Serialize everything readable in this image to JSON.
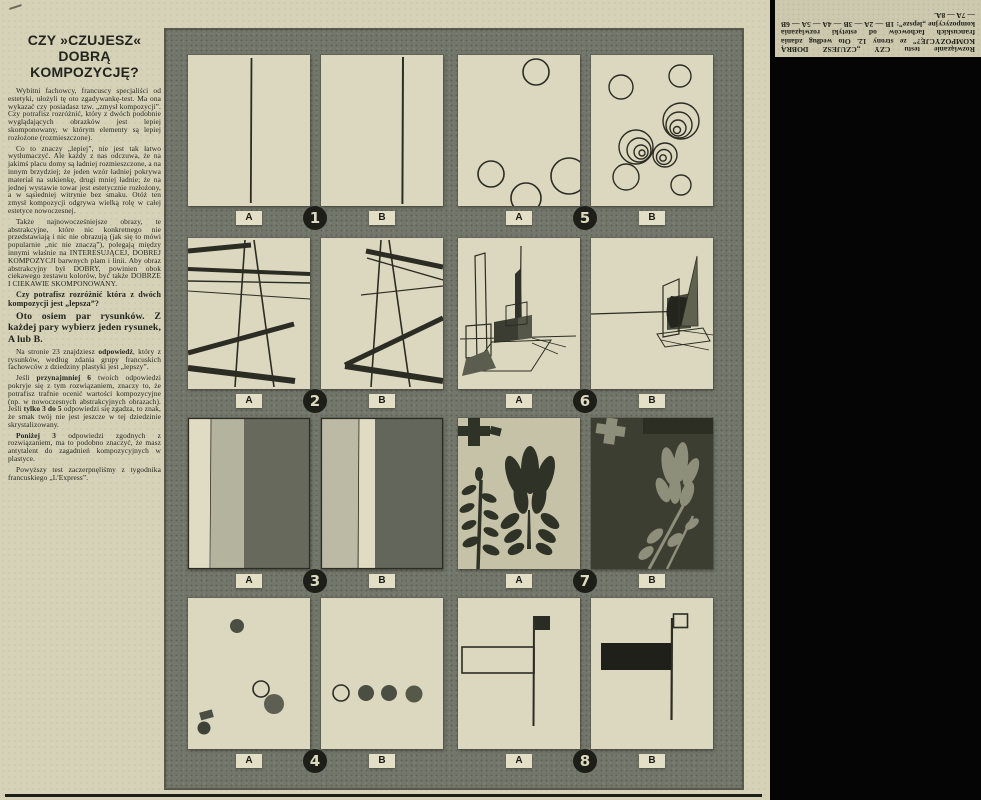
{
  "article": {
    "title": "CZY »CZUJESZ«\nDOBRĄ\nKOMPOZYCJĘ?",
    "paragraphs": [
      {
        "cls": "p-normal",
        "seg": [
          {
            "t": "Wybitni fachowcy, francuscy specjaliści od estetyki, ułożyli tę oto zgadywankę-test. Ma ona wykazać czy posiadasz tzw. „zmysł kompozycji”. Czy potrafisz rozróżnić, który z dwóch podobnie wyglądających obrazków jest lepiej skomponowany, w którym elementy są lepiej rozłożone (rozmieszczone)."
          }
        ]
      },
      {
        "cls": "p-normal",
        "seg": [
          {
            "t": "Co to znaczy „lepiej”, nie jest tak łatwo wytłumaczyć. Ale każdy z nas odczuwa, że na jakimś placu domy są ładniej rozmieszczone, a na innym brzydziej; że jeden wzór ładniej pokrywa materiał na sukienkę, drugi mniej ładnie; że na jednej wystawie towar jest estetycznie rozłożony, a w sąsiedniej witrynie bez smaku. Otóż ten zmysł kompozycji odgrywa wielką rolę w całej estetyce nowoczesnej."
          }
        ]
      },
      {
        "cls": "p-normal",
        "seg": [
          {
            "t": "Także najnowocześniejsze obrazy, te abstrakcyjne, które nic konkretnego nie przedstawiają i nic nie obrazują (jak się to mówi popularnie „nic nie znaczą”), polegają między innymi właśnie na INTERESUJĄCEJ, DOBREJ KOMPOZYCJI barwnych plam i linii. Aby obraz abstrakcyjny był DOBRY, powinien obok ciekawego zestawu kolorów, być także DOBRZE I CIEKAWIE SKOMPONOWANY."
          }
        ]
      },
      {
        "cls": "p-bold-sm",
        "seg": [
          {
            "t": "Czy potrafisz rozróżnić która z dwóch kompozycji jest „lepsza”?"
          }
        ]
      },
      {
        "cls": "p-bold-lg",
        "seg": [
          {
            "t": "Oto osiem par rysunków. Z każdej pary wybierz jeden rysunek, A lub B."
          }
        ]
      },
      {
        "cls": "p-normal",
        "seg": [
          {
            "t": "Na stronie 23 znajdziesz "
          },
          {
            "t": "odpowiedź",
            "b": true
          },
          {
            "t": ", który z rysunków, według zdania grupy francuskich fachowców z dziedziny plastyki jest „lepszy”."
          }
        ]
      },
      {
        "cls": "p-normal",
        "seg": [
          {
            "t": "Jeśli "
          },
          {
            "t": "przynajmniej 6",
            "b": true
          },
          {
            "t": " twoich odpowiedzi pokryje się z tym rozwiązaniem, znaczy to, że potrafisz trafnie ocenić wartości kompozycyjne (np. w nowoczesnych abstrakcyjnych obrazach). Jeśli "
          },
          {
            "t": "tylko 3 do 5",
            "b": true
          },
          {
            "t": " odpowiedzi się zgadza, to znak, że smak twój nie jest jeszcze w tej dziedzinie skrystalizowany."
          }
        ]
      },
      {
        "cls": "p-normal",
        "seg": [
          {
            "t": "Poniżej 3",
            "b": true
          },
          {
            "t": " odpowiedzi zgodnych z rozwiązaniem, ma to podobno znaczyć, że masz antytalent do zagadnień kompozycyjnych w plastyce."
          }
        ]
      },
      {
        "cls": "p-normal",
        "seg": [
          {
            "t": "Powyższy test zaczerpnęliśmy z tygodnika francuskiego „L'Express”."
          }
        ]
      }
    ]
  },
  "quiz": {
    "pairs": [
      {
        "number": "1",
        "a": "A",
        "b": "B"
      },
      {
        "number": "2",
        "a": "A",
        "b": "B"
      },
      {
        "number": "3",
        "a": "A",
        "b": "B"
      },
      {
        "number": "4",
        "a": "A",
        "b": "B"
      },
      {
        "number": "5",
        "a": "A",
        "b": "B"
      },
      {
        "number": "6",
        "a": "A",
        "b": "B"
      },
      {
        "number": "7",
        "a": "A",
        "b": "B"
      },
      {
        "number": "8",
        "a": "A",
        "b": "B"
      }
    ]
  },
  "answer_note": {
    "text": "Rozwiązanie testu CZY „CZUJESZ DOBRĄ KOMPOZYCJĘ?” ze strony 12. Oto według zdania francuskich fachowców od estetyki rozwiązania kompozycyjne „lepsze”: 1B — 2A — 3B — 4A — 5A — 6B — 7A — 8A."
  },
  "colors": {
    "paper": "#d6d2b8",
    "grid_background": "#73766a",
    "panel_cream": "#dcd8bf",
    "ink": "#2b2c24",
    "badge_black": "#1d1e18"
  }
}
